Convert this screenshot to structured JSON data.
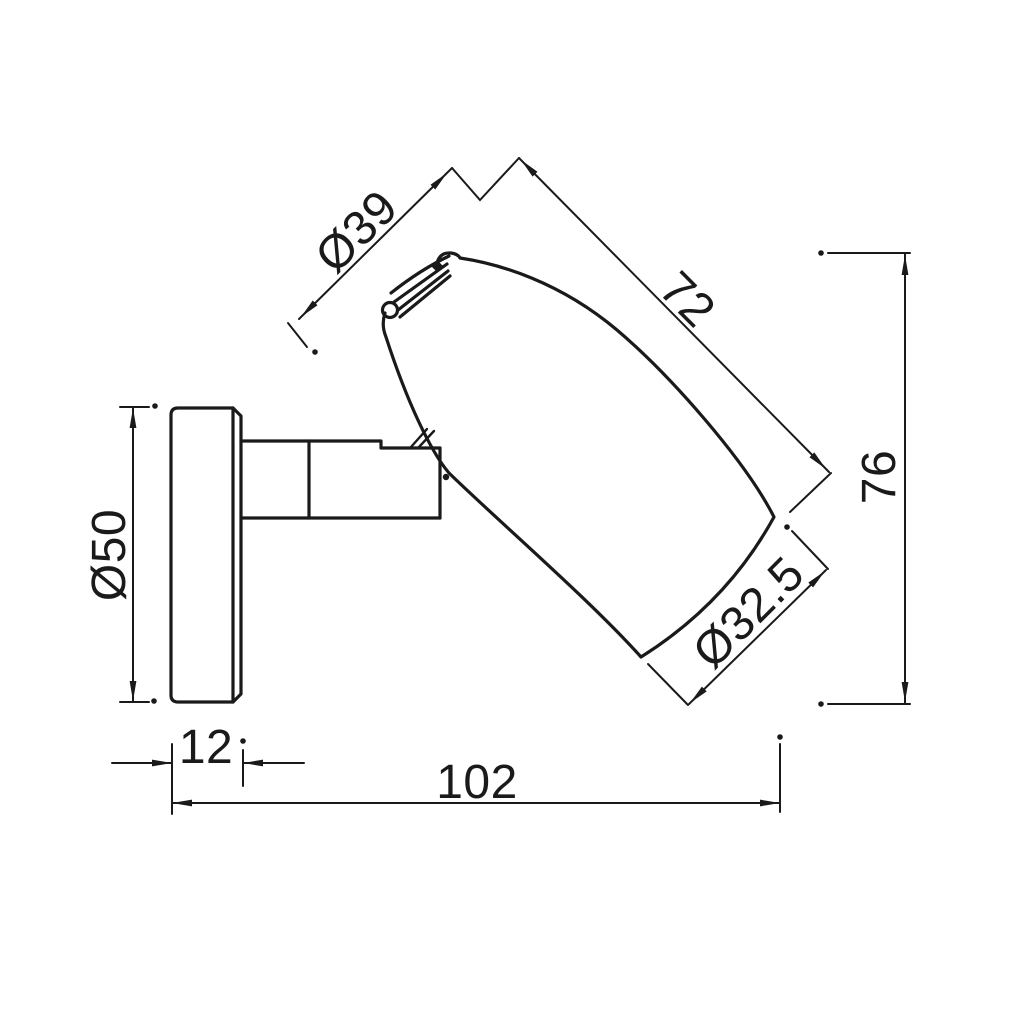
{
  "colors": {
    "ink": "#1a1a1a",
    "background": "#ffffff"
  },
  "dimensions": {
    "neck_diameter": {
      "label": "Ø39"
    },
    "head_length": {
      "label": "72"
    },
    "overall_height": {
      "label": "76"
    },
    "base_diameter": {
      "label": "Ø50"
    },
    "face_diameter": {
      "label": "Ø32.5"
    },
    "base_thickness": {
      "label": "12"
    },
    "overall_length": {
      "label": "102"
    }
  }
}
